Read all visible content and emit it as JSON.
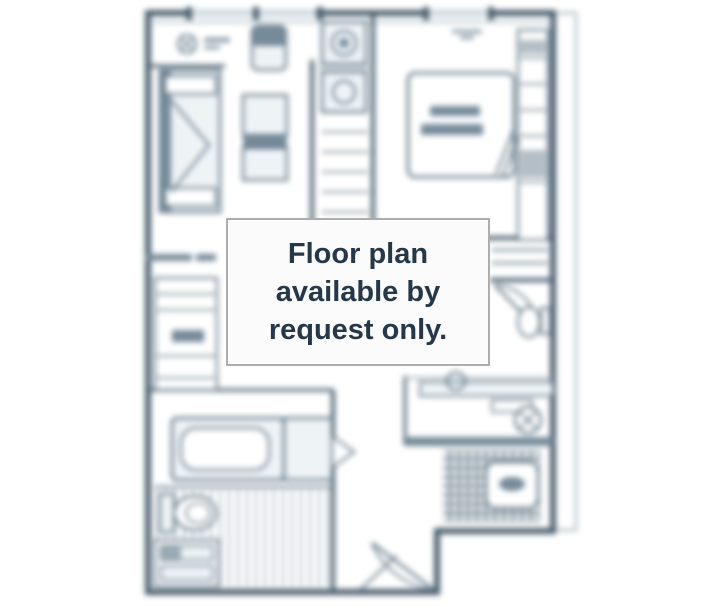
{
  "overlay_notice": {
    "lines": [
      "Floor plan",
      "available by",
      "request only."
    ]
  },
  "colors": {
    "ink": "#51697a",
    "wall": "#3d5464",
    "light": "#93a7b3",
    "fill": "#eef3f6",
    "dark": "#6d8494",
    "notice_text": "#24384a",
    "notice_bg": "#fbfbfb",
    "notice_border": "#adadad",
    "page_bg": "#ffffff"
  }
}
